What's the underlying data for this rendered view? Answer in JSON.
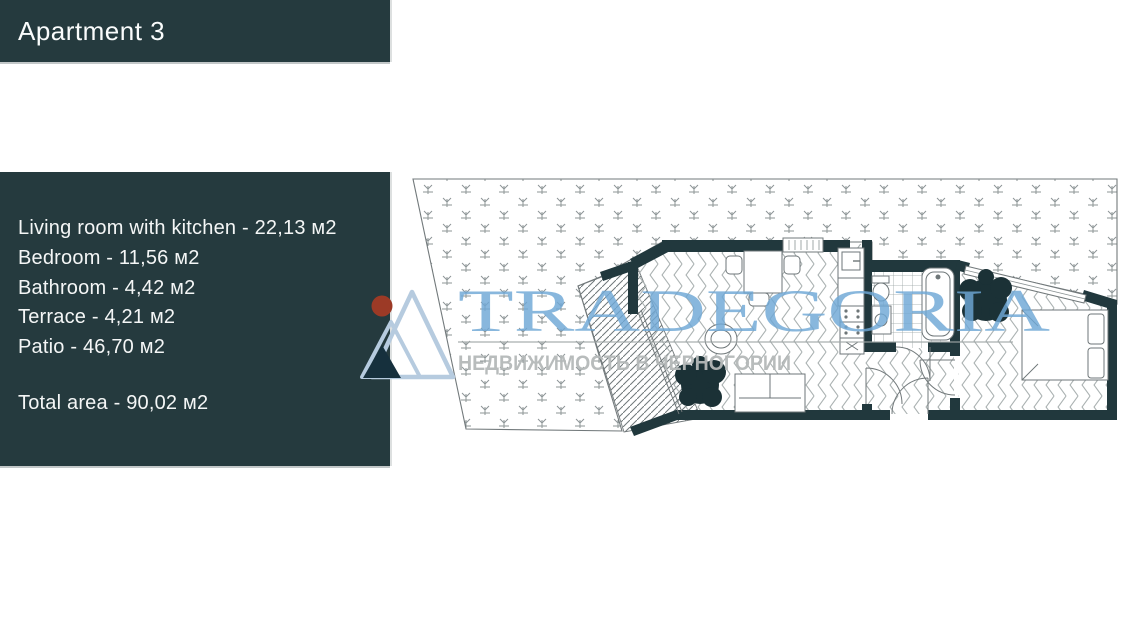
{
  "header": {
    "title": "Apartment 3"
  },
  "info_panel": {
    "lines": [
      "Living room with kitchen - 22,13 м2",
      "Bedroom - 11,56 м2",
      "Bathroom - 4,42 м2",
      "Terrace - 4,21 м2",
      "Patio - 46,70 м2"
    ],
    "total": "Total area - 90,02 м2"
  },
  "watermark": {
    "brand": "TRADEGORIA",
    "tagline": "НЕДВИЖИМОСТЬ В ЧЕРНОГОРИИ",
    "brand_color": "#6fa8d6",
    "tagline_color": "#b5b9b9",
    "sun_color": "#9c3a26",
    "mountain_color": "#b6cbdf",
    "dark_peak_color": "#16303d"
  },
  "palette": {
    "panel_background": "#253a3e",
    "wall_color": "#21383d",
    "plan_line_color": "#72797b"
  }
}
